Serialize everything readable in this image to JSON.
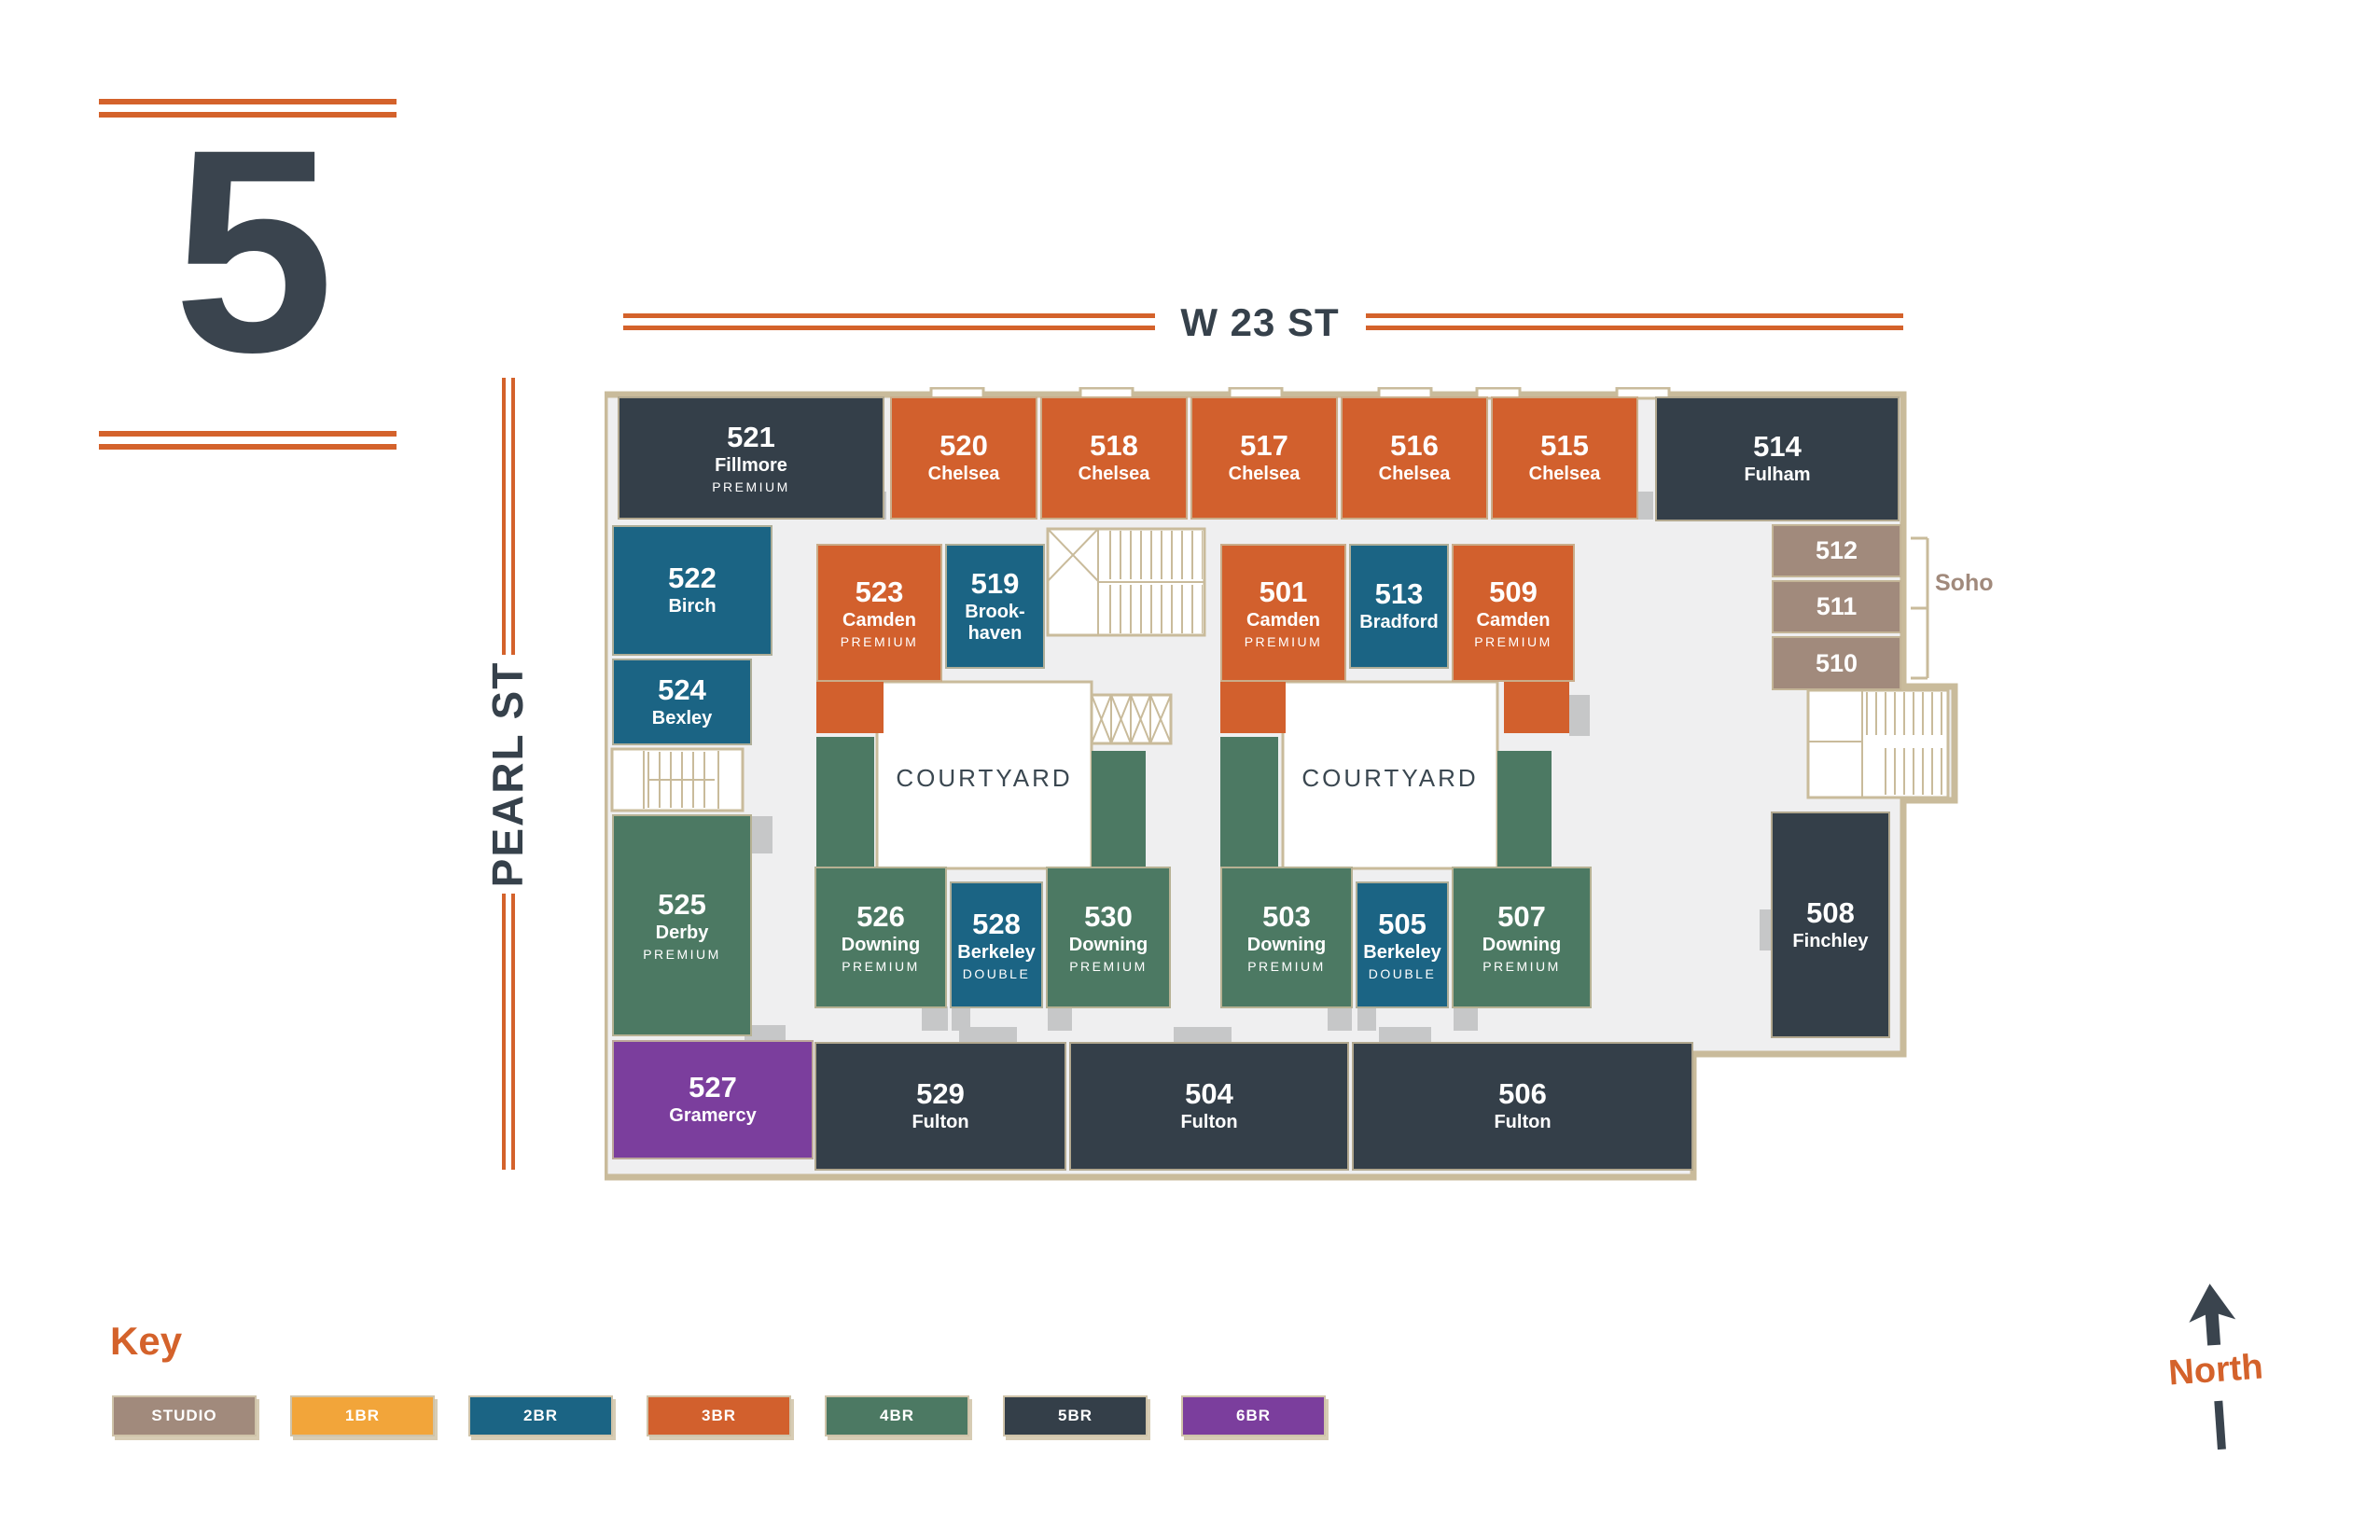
{
  "floor": {
    "number": "5"
  },
  "streets": {
    "top": "W 23 ST",
    "left": "PEARL ST"
  },
  "courtyards": [
    "COURTYARD",
    "COURTYARD"
  ],
  "soho": {
    "label": "Soho"
  },
  "north": {
    "label": "North"
  },
  "key": {
    "title": "Key",
    "items": [
      {
        "label": "STUDIO",
        "type": "studio",
        "color": "#A18A7C"
      },
      {
        "label": "1BR",
        "type": "1br",
        "color": "#F2A53A"
      },
      {
        "label": "2BR",
        "type": "2br",
        "color": "#1B6484"
      },
      {
        "label": "3BR",
        "type": "3br",
        "color": "#D2602D"
      },
      {
        "label": "4BR",
        "type": "4br",
        "color": "#4C7963"
      },
      {
        "label": "5BR",
        "type": "5br",
        "color": "#343F49"
      },
      {
        "label": "6BR",
        "type": "6br",
        "color": "#7B3E9D"
      }
    ]
  },
  "colors": {
    "wall": "#C9BB9B",
    "corridor": "#EFEFF0",
    "ink": "#36414B",
    "accent": "#D4622B",
    "door": "#C6C7C8",
    "courtyard_text": "#3A4750"
  },
  "units": [
    {
      "number": "521",
      "name": "Fillmore",
      "tier": "PREMIUM",
      "type": "5br"
    },
    {
      "number": "520",
      "name": "Chelsea",
      "tier": "",
      "type": "3br"
    },
    {
      "number": "518",
      "name": "Chelsea",
      "tier": "",
      "type": "3br"
    },
    {
      "number": "517",
      "name": "Chelsea",
      "tier": "",
      "type": "3br"
    },
    {
      "number": "516",
      "name": "Chelsea",
      "tier": "",
      "type": "3br"
    },
    {
      "number": "515",
      "name": "Chelsea",
      "tier": "",
      "type": "3br"
    },
    {
      "number": "514",
      "name": "Fulham",
      "tier": "",
      "type": "5br"
    },
    {
      "number": "512",
      "name": "",
      "tier": "",
      "type": "studio"
    },
    {
      "number": "511",
      "name": "",
      "tier": "",
      "type": "studio"
    },
    {
      "number": "510",
      "name": "",
      "tier": "",
      "type": "studio"
    },
    {
      "number": "522",
      "name": "Birch",
      "tier": "",
      "type": "2br"
    },
    {
      "number": "524",
      "name": "Bexley",
      "tier": "",
      "type": "2br"
    },
    {
      "number": "523",
      "name": "Camden",
      "tier": "PREMIUM",
      "type": "3br"
    },
    {
      "number": "519",
      "name": "Brook-\nhaven",
      "tier": "",
      "type": "2br"
    },
    {
      "number": "501",
      "name": "Camden",
      "tier": "PREMIUM",
      "type": "3br"
    },
    {
      "number": "513",
      "name": "Bradford",
      "tier": "",
      "type": "2br"
    },
    {
      "number": "509",
      "name": "Camden",
      "tier": "PREMIUM",
      "type": "3br"
    },
    {
      "number": "525",
      "name": "Derby",
      "tier": "PREMIUM",
      "type": "4br"
    },
    {
      "number": "526",
      "name": "Downing",
      "tier": "PREMIUM",
      "type": "4br"
    },
    {
      "number": "528",
      "name": "Berkeley",
      "tier": "DOUBLE",
      "type": "2br"
    },
    {
      "number": "530",
      "name": "Downing",
      "tier": "PREMIUM",
      "type": "4br"
    },
    {
      "number": "503",
      "name": "Downing",
      "tier": "PREMIUM",
      "type": "4br"
    },
    {
      "number": "505",
      "name": "Berkeley",
      "tier": "DOUBLE",
      "type": "2br"
    },
    {
      "number": "507",
      "name": "Downing",
      "tier": "PREMIUM",
      "type": "4br"
    },
    {
      "number": "508",
      "name": "Finchley",
      "tier": "",
      "type": "5br"
    },
    {
      "number": "527",
      "name": "Gramercy",
      "tier": "",
      "type": "6br"
    },
    {
      "number": "529",
      "name": "Fulton",
      "tier": "",
      "type": "5br"
    },
    {
      "number": "504",
      "name": "Fulton",
      "tier": "",
      "type": "5br"
    },
    {
      "number": "506",
      "name": "Fulton",
      "tier": "",
      "type": "5br"
    }
  ]
}
